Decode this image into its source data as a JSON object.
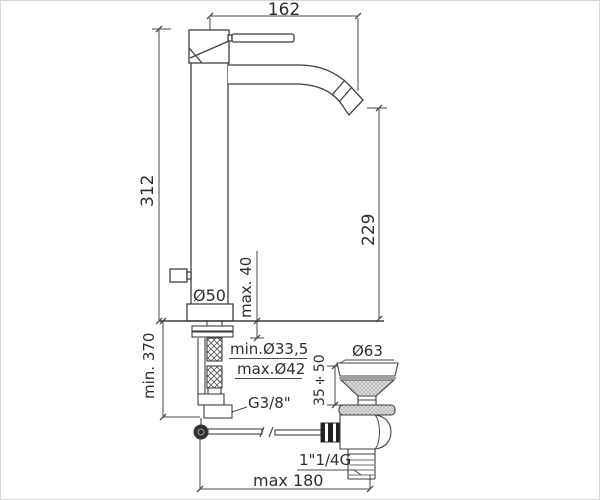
{
  "window": {
    "background": "#ffffff",
    "line_color": "#3f3f3f",
    "text_color": "#2e2e2e",
    "ball_joint_color": "#2f2f2f",
    "stipple_fill": "#d9d9d9"
  },
  "diagram": {
    "labels": {
      "spout_reach": "162",
      "body_height": "312",
      "spout_height": "229",
      "base_diameter": "Ø50",
      "deck_thickness": "max. 40",
      "hole_diameter_min": "min.Ø33,5",
      "hole_diameter_max": "max.Ø42",
      "hose_length": "min. 370",
      "supply_thread": "G3/8\"",
      "waste_flange_diameter": "Ø63",
      "basin_thickness_range": "35÷50",
      "waste_thread": "1\"1/4G",
      "rod_reach": "max 180"
    }
  }
}
